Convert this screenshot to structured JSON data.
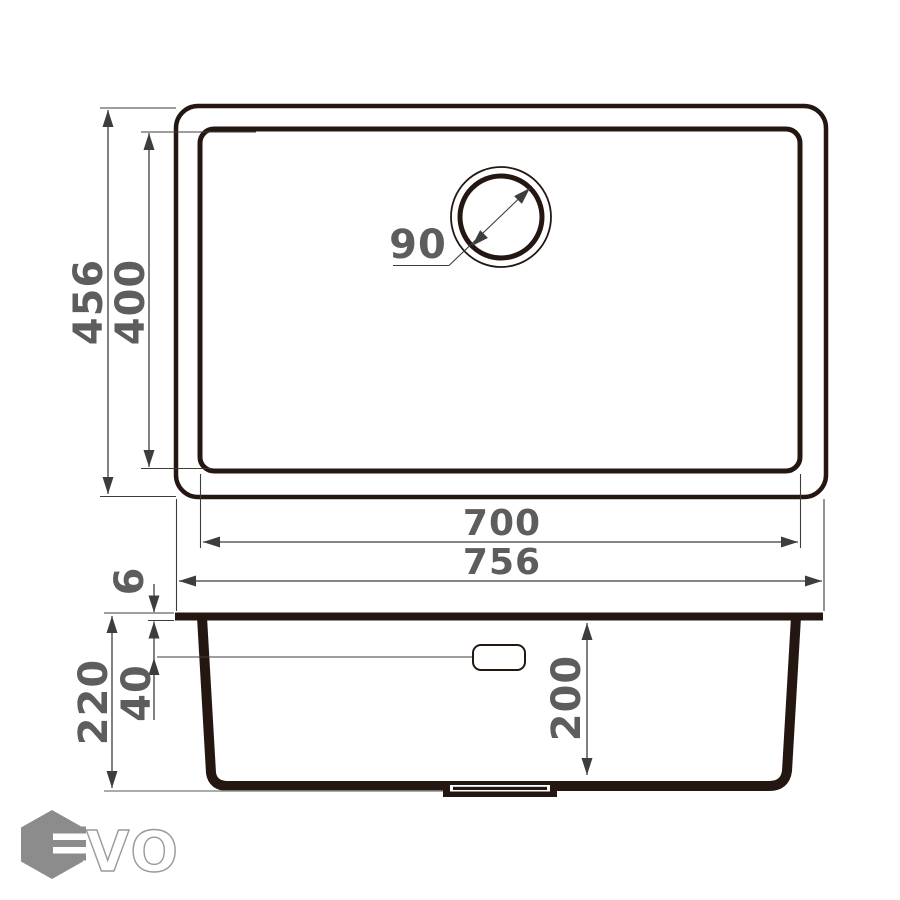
{
  "top_view": {
    "overall_depth_mm": "456",
    "bowl_depth_mm": "400",
    "drain_diameter_mm": "90",
    "bowl_width_mm": "700",
    "overall_width_mm": "756"
  },
  "side_view": {
    "rim_thickness_mm": "6",
    "overflow_offset_mm": "40",
    "total_height_mm": "220",
    "bowl_inner_depth_mm": "200"
  },
  "logo": {
    "text": "VO"
  },
  "colors": {
    "outline": "#241712",
    "dimension_line": "#3d3d3d",
    "dimension_text": "#5d5d5d",
    "baseline": "#8f8f8f",
    "logo_gray": "#8c8c8c",
    "background": "#ffffff"
  }
}
